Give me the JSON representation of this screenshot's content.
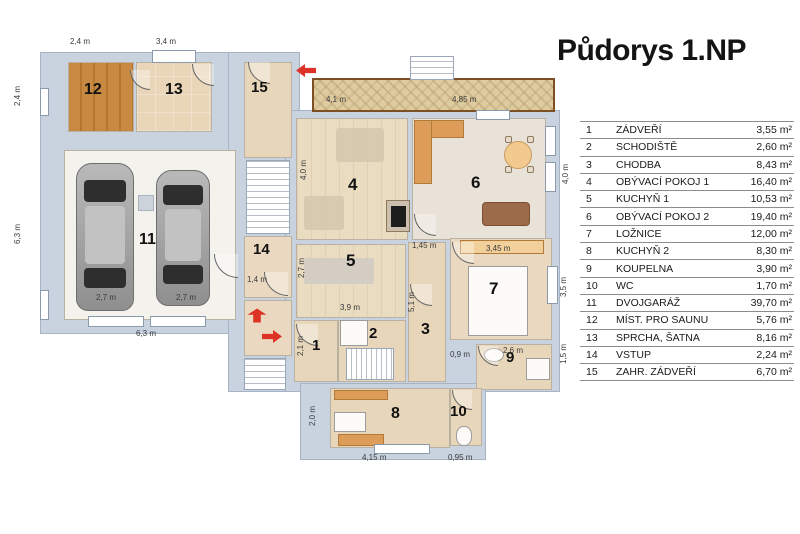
{
  "title": "Půdorys 1.NP",
  "legend": {
    "rows": [
      {
        "n": "1",
        "name": "ZÁDVEŘÍ",
        "area": "3,55 m²"
      },
      {
        "n": "2",
        "name": "SCHODIŠTĚ",
        "area": "2,60 m²"
      },
      {
        "n": "3",
        "name": "CHODBA",
        "area": "8,43 m²"
      },
      {
        "n": "4",
        "name": "OBÝVACÍ POKOJ 1",
        "area": "16,40 m²"
      },
      {
        "n": "5",
        "name": "KUCHYŇ 1",
        "area": "10,53 m²"
      },
      {
        "n": "6",
        "name": "OBÝVACÍ POKOJ 2",
        "area": "19,40 m²"
      },
      {
        "n": "7",
        "name": "LOŽNICE",
        "area": "12,00 m²"
      },
      {
        "n": "8",
        "name": "KUCHYŇ 2",
        "area": "8,30 m²"
      },
      {
        "n": "9",
        "name": "KOUPELNA",
        "area": "3,90 m²"
      },
      {
        "n": "10",
        "name": "WC",
        "area": "1,70 m²"
      },
      {
        "n": "11",
        "name": "DVOJGARÁŽ",
        "area": "39,70 m²"
      },
      {
        "n": "12",
        "name": "MÍST. PRO SAUNU",
        "area": "5,76 m²"
      },
      {
        "n": "13",
        "name": "SPRCHA, ŠATNA",
        "area": "8,16 m²"
      },
      {
        "n": "14",
        "name": "VSTUP",
        "area": "2,24 m²"
      },
      {
        "n": "15",
        "name": "ZAHR. ZÁDVEŘÍ",
        "area": "6,70 m²"
      }
    ]
  },
  "plan": {
    "room_labels": [
      {
        "n": "1",
        "x": 312,
        "y": 338,
        "fs": 15
      },
      {
        "n": "2",
        "x": 369,
        "y": 326,
        "fs": 15
      },
      {
        "n": "3",
        "x": 421,
        "y": 322,
        "fs": 16
      },
      {
        "n": "4",
        "x": 348,
        "y": 176,
        "fs": 17
      },
      {
        "n": "5",
        "x": 346,
        "y": 252,
        "fs": 17
      },
      {
        "n": "6",
        "x": 471,
        "y": 174,
        "fs": 17
      },
      {
        "n": "7",
        "x": 489,
        "y": 280,
        "fs": 17
      },
      {
        "n": "8",
        "x": 391,
        "y": 406,
        "fs": 16
      },
      {
        "n": "9",
        "x": 506,
        "y": 350,
        "fs": 15
      },
      {
        "n": "10",
        "x": 450,
        "y": 404,
        "fs": 15
      },
      {
        "n": "11",
        "x": 139,
        "y": 232,
        "fs": 16
      },
      {
        "n": "12",
        "x": 84,
        "y": 82,
        "fs": 16
      },
      {
        "n": "13",
        "x": 165,
        "y": 82,
        "fs": 16
      },
      {
        "n": "14",
        "x": 253,
        "y": 242,
        "fs": 15
      },
      {
        "n": "15",
        "x": 251,
        "y": 80,
        "fs": 15
      }
    ],
    "dimensions": [
      {
        "t": "2,4 m",
        "x": 70,
        "y": 38,
        "rot": false
      },
      {
        "t": "3,4 m",
        "x": 156,
        "y": 38,
        "rot": false
      },
      {
        "t": "4,1 m",
        "x": 326,
        "y": 96,
        "rot": false
      },
      {
        "t": "4,85 m",
        "x": 452,
        "y": 96,
        "rot": false
      },
      {
        "t": "2,4 m",
        "x": 14,
        "y": 106,
        "rot": true
      },
      {
        "t": "6,3 m",
        "x": 14,
        "y": 244,
        "rot": true
      },
      {
        "t": "2,7 m",
        "x": 96,
        "y": 294,
        "rot": false
      },
      {
        "t": "2,7 m",
        "x": 176,
        "y": 294,
        "rot": false
      },
      {
        "t": "6,3 m",
        "x": 136,
        "y": 330,
        "rot": false
      },
      {
        "t": "1,4 m",
        "x": 247,
        "y": 276,
        "rot": false
      },
      {
        "t": "4,0 m",
        "x": 300,
        "y": 180,
        "rot": true
      },
      {
        "t": "2,7 m",
        "x": 298,
        "y": 278,
        "rot": true
      },
      {
        "t": "3,9 m",
        "x": 340,
        "y": 304,
        "rot": false
      },
      {
        "t": "2,1 m",
        "x": 297,
        "y": 356,
        "rot": true
      },
      {
        "t": "1,45 m",
        "x": 412,
        "y": 242,
        "rot": false
      },
      {
        "t": "5,1 m",
        "x": 408,
        "y": 312,
        "rot": true
      },
      {
        "t": "0,9 m",
        "x": 450,
        "y": 351,
        "rot": false
      },
      {
        "t": "3,45 m",
        "x": 486,
        "y": 245,
        "rot": false
      },
      {
        "t": "2,6 m",
        "x": 503,
        "y": 347,
        "rot": false
      },
      {
        "t": "4,0 m",
        "x": 562,
        "y": 184,
        "rot": true
      },
      {
        "t": "3,5 m",
        "x": 560,
        "y": 297,
        "rot": true
      },
      {
        "t": "1,5 m",
        "x": 560,
        "y": 364,
        "rot": true
      },
      {
        "t": "2,0 m",
        "x": 309,
        "y": 426,
        "rot": true
      },
      {
        "t": "4,15 m",
        "x": 362,
        "y": 454,
        "rot": false
      },
      {
        "t": "0,95 m",
        "x": 448,
        "y": 454,
        "rot": false
      }
    ]
  }
}
